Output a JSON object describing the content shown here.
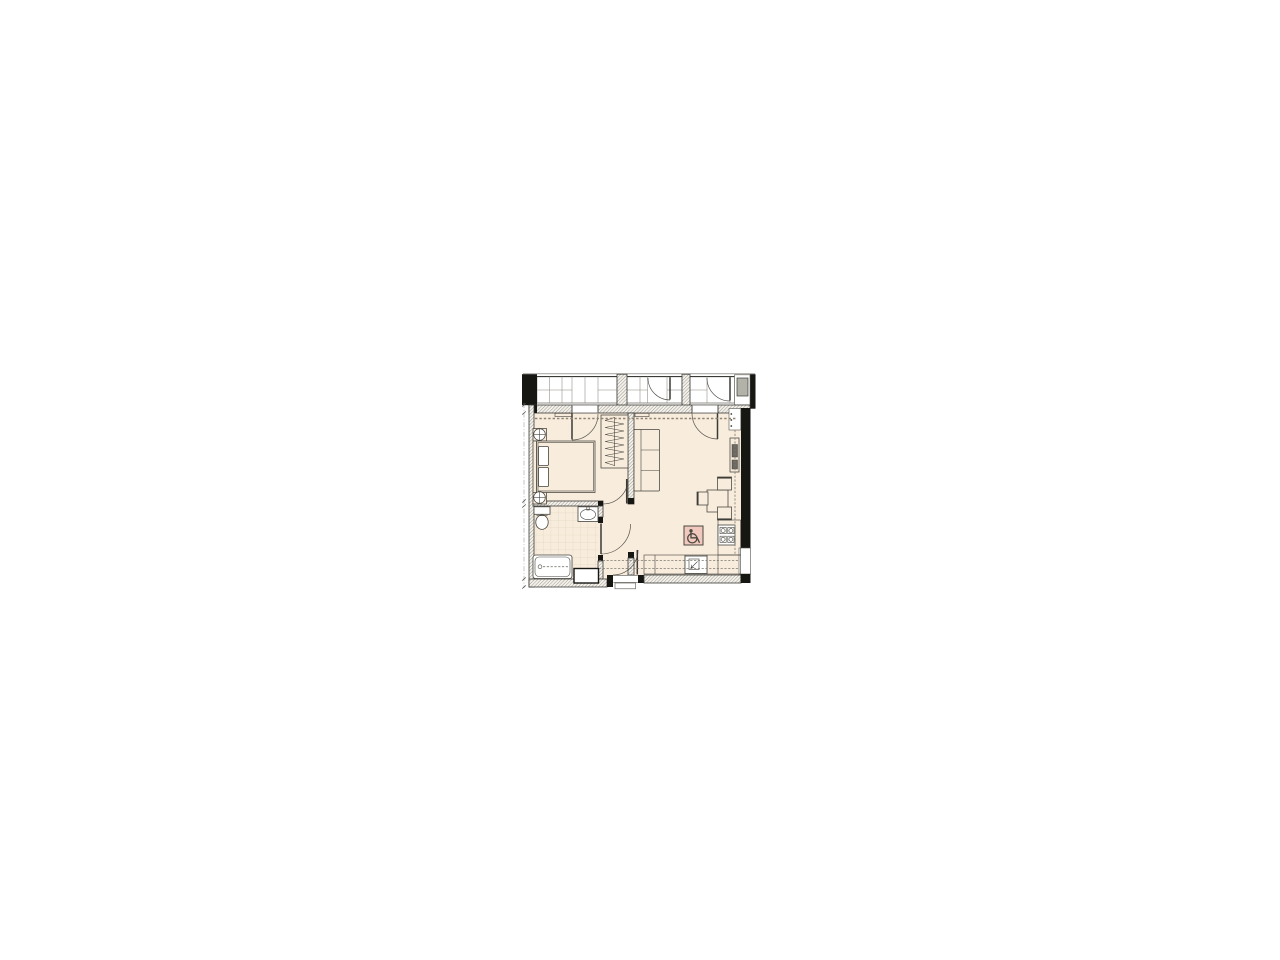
{
  "canvas": {
    "width": 1280,
    "height": 960,
    "background": "#ffffff"
  },
  "plan": {
    "type": "apartment-floor-plan",
    "left": 521,
    "top": 372,
    "width": 236,
    "height": 220,
    "colors": {
      "floor": "#f8ecdc",
      "balcony": "#ffffff",
      "sanitary": "#ffffff",
      "wallLine": "#3b3a36",
      "hatchLine": "#77756d",
      "hatchFill": "#f4f1ea",
      "black": "#161613",
      "furniture": "#45433c",
      "door": "#56544e",
      "dash": "#8f8373",
      "cabinetDash": "#7d7a72",
      "tile": "#d6c9b4",
      "acUnit": "#b3b2a8",
      "badgeFill": "#f0c8bd",
      "badgeLine": "#4a4840",
      "dim": "#8a8a85"
    },
    "rooms": [
      {
        "name": "bedroom"
      },
      {
        "name": "living-room-with-kitchen"
      },
      {
        "name": "bathroom"
      },
      {
        "name": "hallway"
      },
      {
        "name": "glazed-balcony"
      }
    ],
    "fixtures": [
      "double-bed",
      "pillows",
      "nightstands-with-lamp-symbols",
      "wardrobe-with-hanger-rail",
      "under-window-radiators",
      "sofa-3-cushions",
      "dining-table",
      "dining-chairs",
      "kitchen-counter",
      "kitchen-sink",
      "cooktop-4-burners",
      "wall-heating-unit",
      "toilet",
      "washbasin",
      "bathtub",
      "utility-niche",
      "service-shaft",
      "ac-unit-on-balcony",
      "entrance-door-with-threshold",
      "balcony-doors",
      "bedroom-door",
      "bathroom-door",
      "wheelchair-accessibility-marker"
    ],
    "counts": {
      "sofa_cushions": 3,
      "dining_chairs": 3,
      "cooktop_burners": 4,
      "balcony_door_arcs": 2
    },
    "accessibility": {
      "symbol": "wheelchair"
    }
  }
}
